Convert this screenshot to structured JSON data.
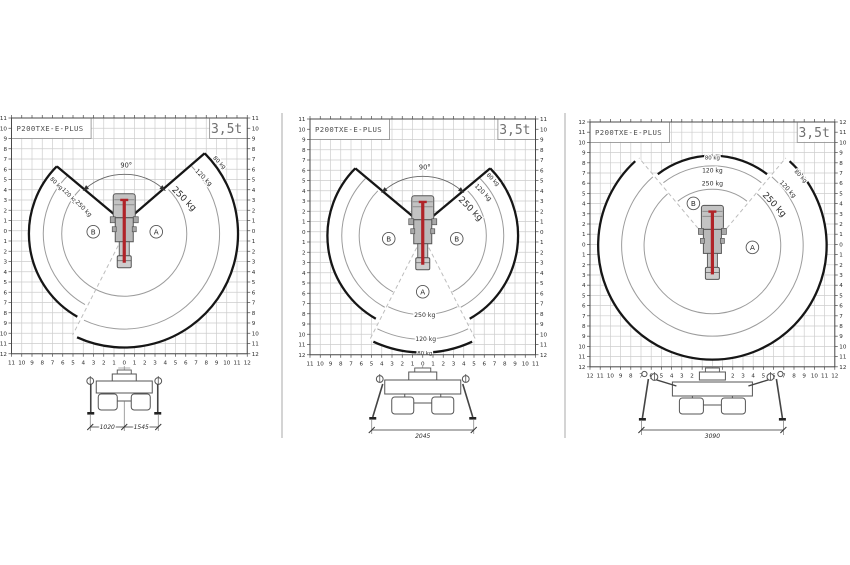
{
  "page": {
    "background": "#ffffff"
  },
  "chart_data": [
    {
      "type": "area",
      "diagram": "outreach-load-chart-outriggers-narrow",
      "title": "P200TXE-E-PLUS",
      "weight_badge": "3,5t",
      "rotation_label": "90°",
      "zone_letters": [
        "B",
        "A"
      ],
      "capacity_labels_left_edge": [
        "80 kg",
        "120 kg",
        "250 kg"
      ],
      "capacity_labels_right_edge": [
        "80 kg",
        "120 kg",
        "250 kg"
      ],
      "load_zones": [
        {
          "load": "250 kg",
          "radius_main_m": 6.1,
          "radius_sector_m": 6.1
        },
        {
          "load": "120 kg",
          "radius_main_m": 7.9,
          "radius_sector_m": 9.3
        },
        {
          "load": "80 kg",
          "radius_main_m": 9.3,
          "radius_sector_m": 11.1
        }
      ],
      "axis_labels": {
        "left": [
          "11",
          "10",
          "9",
          "8",
          "7",
          "6",
          "5",
          "4",
          "3",
          "2",
          "1",
          "0",
          "1",
          "2",
          "3",
          "4",
          "5",
          "6",
          "7",
          "8",
          "9",
          "10",
          "11",
          "12"
        ],
        "right": [
          "11",
          "10",
          "9",
          "8",
          "7",
          "6",
          "5",
          "4",
          "3",
          "2",
          "1",
          "0",
          "1",
          "2",
          "3",
          "4",
          "5",
          "6",
          "7",
          "8",
          "9",
          "10",
          "11",
          "12"
        ],
        "bottom": [
          "11",
          "10",
          "9",
          "8",
          "7",
          "6",
          "5",
          "4",
          "3",
          "2",
          "1",
          "0",
          "1",
          "2",
          "3",
          "4",
          "5",
          "6",
          "7",
          "8",
          "9",
          "10",
          "11",
          "12"
        ]
      },
      "outrigger_dimensions_mm": [
        "1020",
        "1545"
      ]
    },
    {
      "type": "area",
      "diagram": "outreach-load-chart-outriggers-mid",
      "title": "P200TXE-E-PLUS",
      "weight_badge": "3,5t",
      "rotation_label": "90°",
      "zone_letters": [
        "B",
        "B",
        "A"
      ],
      "capacity_labels_right_edge": [
        "80 kg",
        "120 kg",
        "250 kg"
      ],
      "capacity_labels_rear": [
        "250 kg",
        "120 kg",
        "80 kg"
      ],
      "load_zones": [
        {
          "load": "250 kg",
          "radius_main_m": 6.2,
          "radius_sector_m": 7.7
        },
        {
          "load": "120 kg",
          "radius_main_m": 7.9,
          "radius_sector_m": 10.1
        },
        {
          "load": "80 kg",
          "radius_main_m": 9.3,
          "radius_sector_m": 11.4
        }
      ],
      "axis_labels": {
        "left": [
          "11",
          "10",
          "9",
          "8",
          "7",
          "6",
          "5",
          "4",
          "3",
          "2",
          "1",
          "0",
          "1",
          "2",
          "3",
          "4",
          "5",
          "6",
          "7",
          "8",
          "9",
          "10",
          "11",
          "12"
        ],
        "right": [
          "11",
          "10",
          "9",
          "8",
          "7",
          "6",
          "5",
          "4",
          "3",
          "2",
          "1",
          "0",
          "1",
          "2",
          "3",
          "4",
          "5",
          "6",
          "7",
          "8",
          "9",
          "10",
          "11",
          "12"
        ],
        "bottom": [
          "11",
          "10",
          "9",
          "8",
          "7",
          "6",
          "5",
          "4",
          "3",
          "2",
          "1",
          "0",
          "1",
          "2",
          "3",
          "4",
          "5",
          "6",
          "7",
          "8",
          "9",
          "10",
          "11"
        ]
      },
      "outrigger_dimensions_mm": [
        "2045"
      ]
    },
    {
      "type": "area",
      "diagram": "outreach-load-chart-outriggers-full",
      "title": "P200TXE-E-PLUS",
      "weight_badge": "3,5t",
      "rotation_label": "",
      "zone_letters": [
        "B",
        "A"
      ],
      "capacity_labels_right_edge": [
        "80 kg",
        "120 kg",
        "250 kg"
      ],
      "capacity_labels_front": [
        "80 kg",
        "120 kg",
        "250 kg"
      ],
      "load_zones": [
        {
          "load": "250 kg",
          "radius_main_m": 6.7,
          "radius_sector_m": 5.5
        },
        {
          "load": "120 kg",
          "radius_main_m": 8.9,
          "radius_sector_m": 7.8
        },
        {
          "load": "80 kg",
          "radius_main_m": 11.2,
          "radius_sector_m": 8.8
        }
      ],
      "axis_labels": {
        "left": [
          "12",
          "11",
          "10",
          "9",
          "8",
          "7",
          "6",
          "5",
          "4",
          "3",
          "2",
          "1",
          "0",
          "1",
          "2",
          "3",
          "4",
          "5",
          "6",
          "7",
          "8",
          "9",
          "10",
          "11",
          "12"
        ],
        "right": [
          "12",
          "11",
          "10",
          "9",
          "8",
          "7",
          "6",
          "5",
          "4",
          "3",
          "2",
          "1",
          "0",
          "1",
          "2",
          "3",
          "4",
          "5",
          "6",
          "7",
          "8",
          "9",
          "10",
          "11",
          "12"
        ],
        "bottom": [
          "12",
          "11",
          "10",
          "9",
          "8",
          "7",
          "6",
          "5",
          "4",
          "3",
          "2",
          "1",
          "0",
          "1",
          "2",
          "3",
          "4",
          "5",
          "6",
          "7",
          "8",
          "9",
          "10",
          "11",
          "12"
        ]
      },
      "outrigger_dimensions_mm": [
        "3090"
      ]
    }
  ]
}
